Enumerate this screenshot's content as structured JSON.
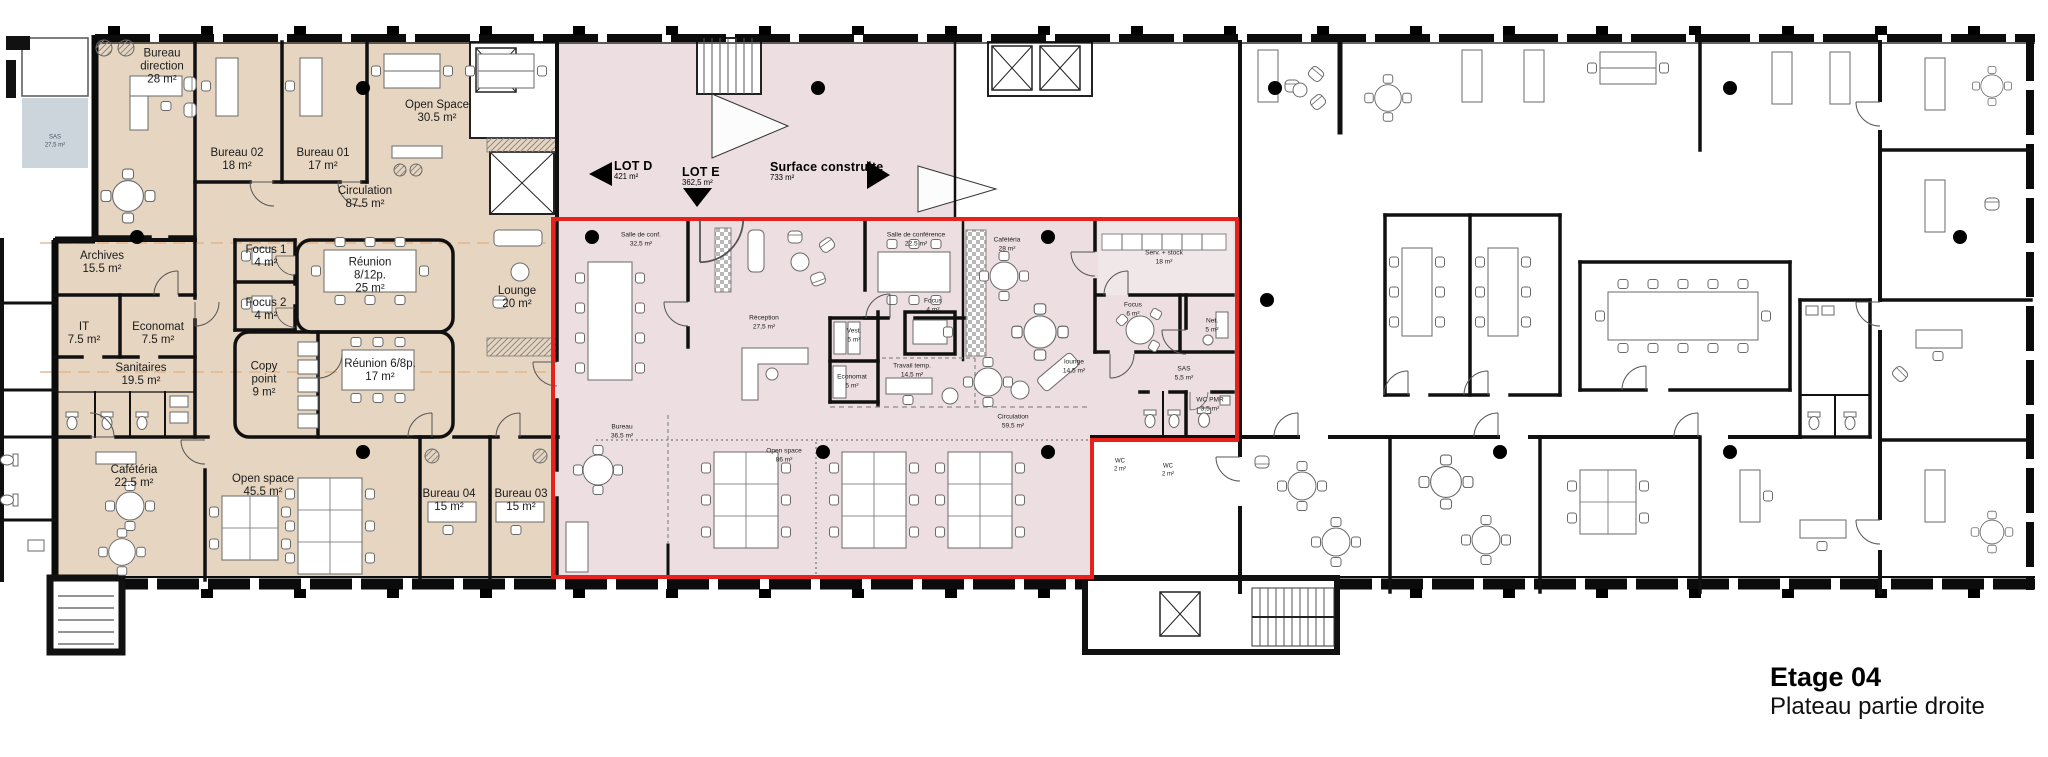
{
  "title_block": {
    "floor": "Etage 04",
    "subtitle": "Plateau partie droite"
  },
  "lot_labels": {
    "lot_d": {
      "name": "LOT D",
      "area": "421 m²"
    },
    "lot_e": {
      "name": "LOT E",
      "area": "362,5 m²"
    },
    "surface": {
      "name": "Surface construite",
      "area": "733 m²"
    }
  },
  "rooms": {
    "bureau_direction": {
      "name": "Bureau direction",
      "area": "28 m²"
    },
    "bureau_02": {
      "name": "Bureau 02",
      "area": "18 m²"
    },
    "bureau_01": {
      "name": "Bureau 01",
      "area": "17 m²"
    },
    "open_space_1": {
      "name": "Open Space",
      "area": "30.5 m²"
    },
    "circulation_1": {
      "name": "Circulation",
      "area": "87.5 m²"
    },
    "archives": {
      "name": "Archives",
      "area": "15.5 m²"
    },
    "focus_1": {
      "name": "Focus 1",
      "area": "4 m²"
    },
    "reunion_8_12": {
      "name": "Réunion 8/12p.",
      "area": "25 m²"
    },
    "focus_2": {
      "name": "Focus 2",
      "area": "4 m²"
    },
    "it": {
      "name": "IT",
      "area": "7.5 m²"
    },
    "economat_1": {
      "name": "Economat",
      "area": "7.5 m²"
    },
    "copy_point": {
      "name": "Copy point",
      "area": "9 m²"
    },
    "reunion_6_8": {
      "name": "Réunion 6/8p.",
      "area": "17 m²"
    },
    "sanitaires": {
      "name": "Sanitaires",
      "area": "19.5 m²"
    },
    "lounge_1": {
      "name": "Lounge",
      "area": "20 m²"
    },
    "cafeteria_1": {
      "name": "Cafétéria",
      "area": "22.5 m²"
    },
    "open_space_2": {
      "name": "Open space",
      "area": "45.5 m²"
    },
    "bureau_04": {
      "name": "Bureau 04",
      "area": "15 m²"
    },
    "bureau_03": {
      "name": "Bureau 03",
      "area": "15 m²"
    },
    "salle_de_conf": {
      "name": "Salle de conf.",
      "area": "32,5 m²"
    },
    "reception": {
      "name": "Réception",
      "area": "27,5 m²"
    },
    "salle_de_conference": {
      "name": "Salle de conférence",
      "area": "22.5 m²"
    },
    "cafeteria_2": {
      "name": "Cafétéria",
      "area": "28 m²"
    },
    "serv_stock": {
      "name": "Serv. + stock",
      "area": "18 m²"
    },
    "vest": {
      "name": "Vest.",
      "area": "5 m²"
    },
    "focus_3": {
      "name": "Focus",
      "area": "4 m²"
    },
    "economat_2": {
      "name": "Economat",
      "area": "5 m²"
    },
    "travail_temp": {
      "name": "Travail temp.",
      "area": "14,5 m²"
    },
    "lounge_2": {
      "name": "lounge",
      "area": "14,5 m²"
    },
    "circulation_2": {
      "name": "Circulation",
      "area": "59,5 m²"
    },
    "focus_4": {
      "name": "Focus",
      "area": "6 m²"
    },
    "net": {
      "name": "Net.",
      "area": "5 m²"
    },
    "sas_1": {
      "name": "SAS",
      "area": "5,5 m²"
    },
    "wc_pmr": {
      "name": "WC PMR",
      "area": "3,5 m²"
    },
    "bureau_lot": {
      "name": "Bureau",
      "area": "36,5 m²"
    },
    "open_space_3": {
      "name": "Open space",
      "area": "86 m²"
    },
    "wc_1": {
      "name": "WC",
      "area": "2 m²"
    },
    "wc_2": {
      "name": "WC",
      "area": "2 m²"
    },
    "sas_entry": {
      "name": "SAS",
      "area": "27,5 m²"
    }
  },
  "colors": {
    "zone_beige": "#e6d5c0",
    "zone_pink": "#ecdee1",
    "zone_pink_light": "#f0e7e9",
    "lot_outline_red": "#e8211d",
    "sas_gray": "#cdd5dc",
    "axis_dash_orange": "#e2b083"
  }
}
